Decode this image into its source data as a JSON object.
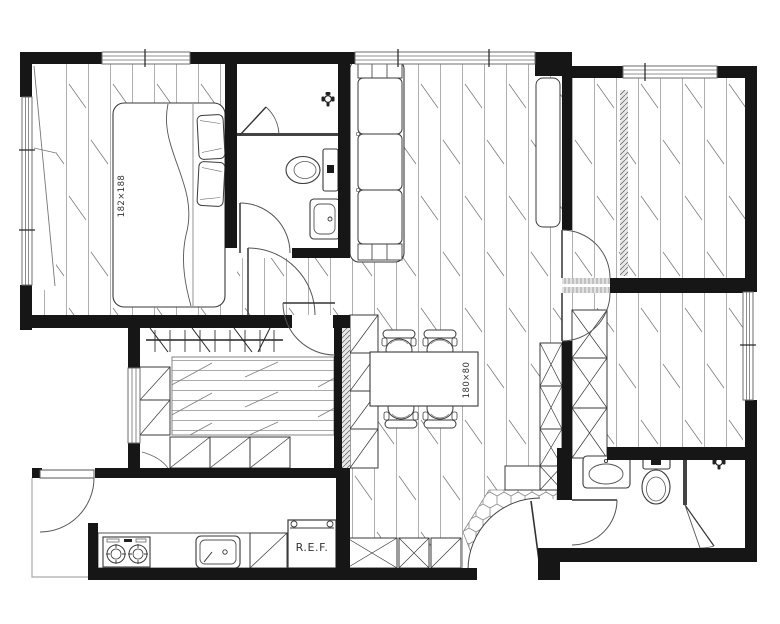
{
  "floor_plan": {
    "labels": {
      "bed_size": "182×188",
      "dining_table_size": "180×80",
      "refrigerator": "R.E.F."
    },
    "colors": {
      "background": "#ffffff",
      "wall": "#161616",
      "furniture_line": "#3a3a3a",
      "floor_line": "#9b9b9b",
      "window_line": "#6e6e6e",
      "hatch_line": "#5a5a5a"
    }
  }
}
